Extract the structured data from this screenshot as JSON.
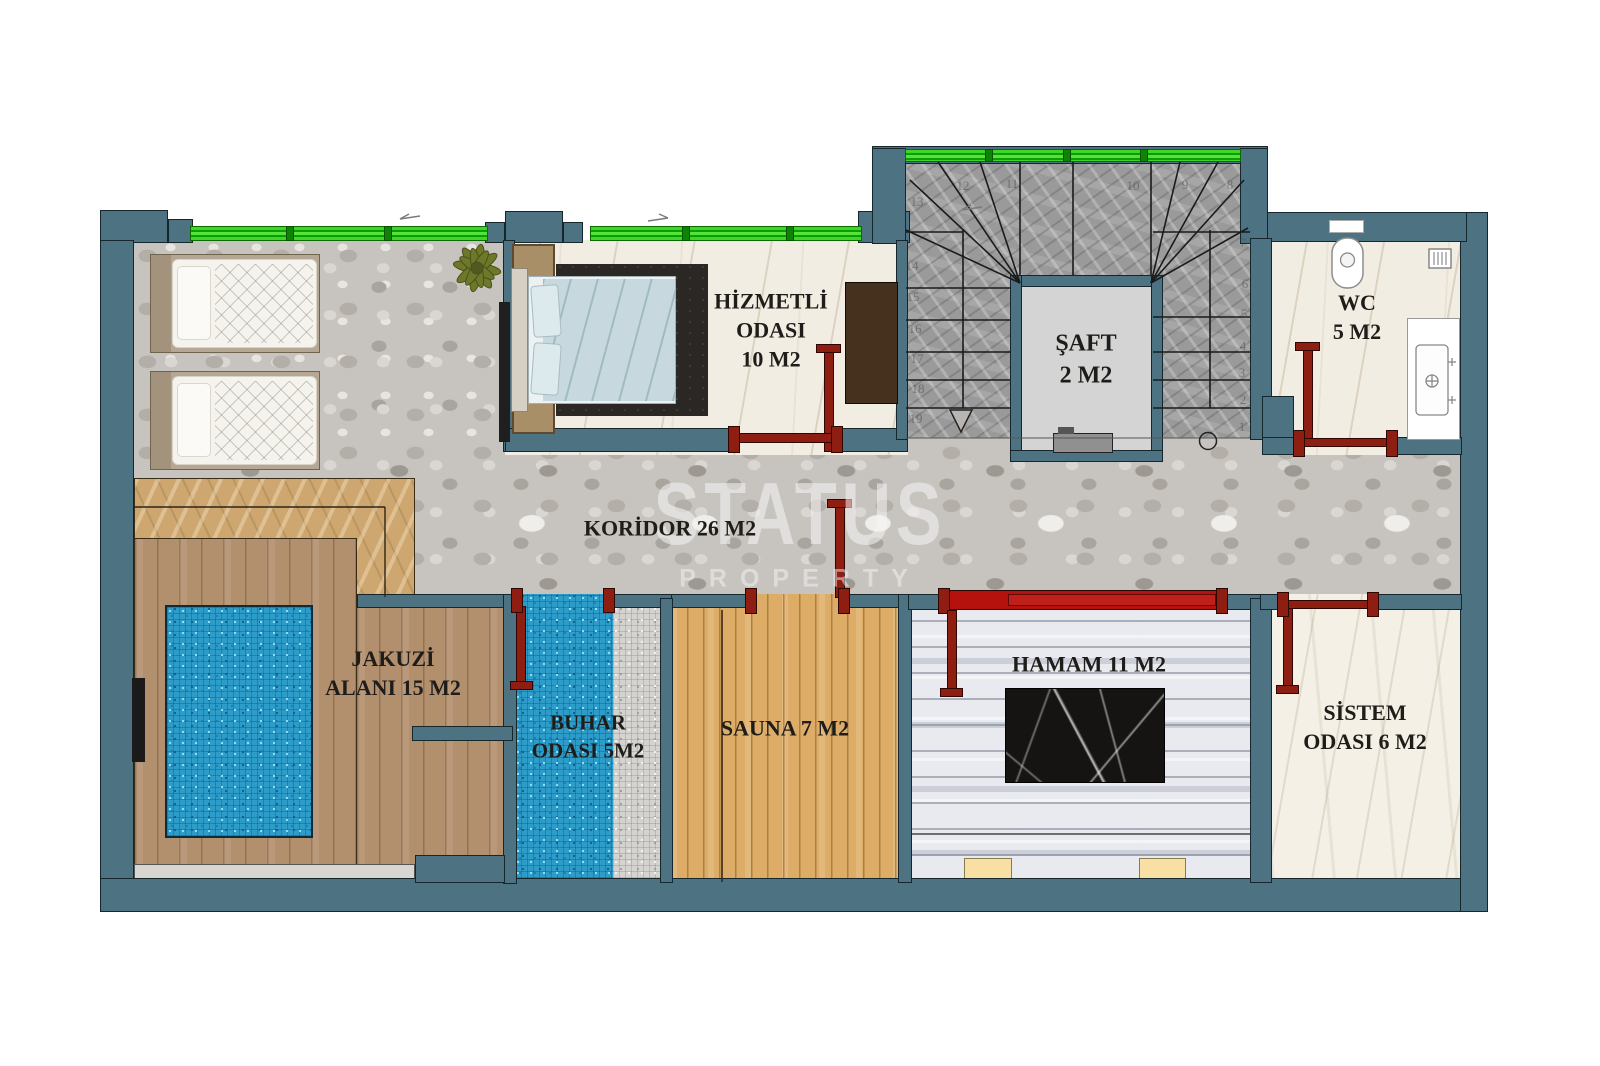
{
  "watermark": {
    "brand": "STATUS",
    "sub": "PROPERTY"
  },
  "labels": {
    "hizmetli": {
      "l1": "HİZMETLİ",
      "l2": "ODASI",
      "l3": "10 M2"
    },
    "saft": {
      "l1": "ŞAFT",
      "l2": "2 M2"
    },
    "wc": {
      "l1": "WC",
      "l2": "5 M2"
    },
    "koridor": {
      "l1": "KORİDOR 26 M2"
    },
    "jakuzi": {
      "l1": "JAKUZİ",
      "l2": "ALANI 15 M2"
    },
    "buhar": {
      "l1": "BUHAR",
      "l2": "ODASI 5M2"
    },
    "sauna": {
      "l1": "SAUNA 7 M2"
    },
    "hamam": {
      "l1": "HAMAM 11 M2"
    },
    "sistem": {
      "l1": "SİSTEM",
      "l2": "ODASI 6 M2"
    }
  },
  "stairs": {
    "numbers": [
      "1",
      "2",
      "3",
      "4",
      "5",
      "6",
      "7",
      "8",
      "9",
      "10",
      "11",
      "12",
      "13",
      "14",
      "15",
      "16",
      "17",
      "18",
      "19"
    ]
  },
  "colors": {
    "wall": "#4d7382",
    "window_green": "#3fd62a",
    "door_maroon": "#8e1d12",
    "slider_red": "#b5120e",
    "pool_blue": "#2e9cc9",
    "deck_wood": "#b28f6d",
    "sauna_wood": "#ddad68",
    "tan_marble": "#cda76f",
    "cream_bench": "#f8dfa3"
  }
}
